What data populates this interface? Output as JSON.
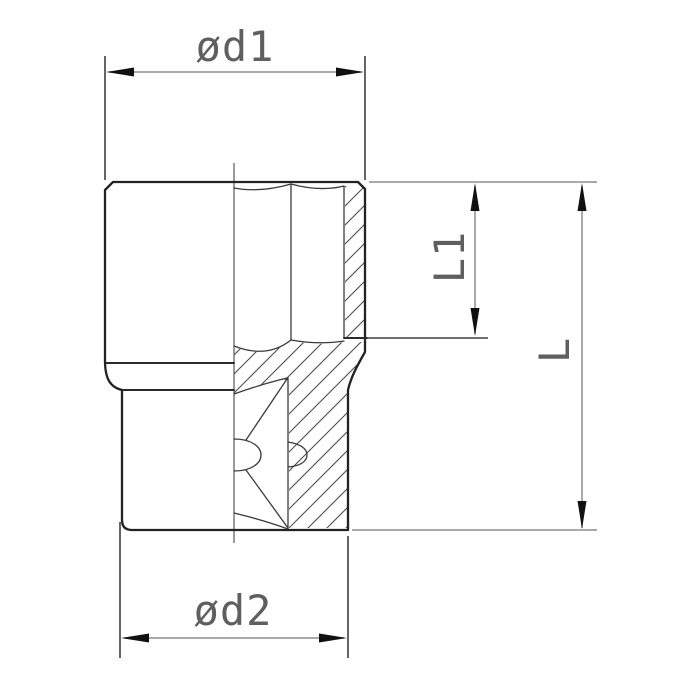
{
  "drawing": {
    "labels": {
      "d1": "ød1",
      "d2": "ød2",
      "l1": "L1",
      "l": "L"
    },
    "colors": {
      "background": "#ffffff",
      "object_line": "#222222",
      "detail_line": "#3a3a3a",
      "dimension_line": "#8e8e8e",
      "arrowhead": "#111111",
      "hatch_line": "#4d4d4d",
      "label_text": "#5f5f5f"
    }
  }
}
